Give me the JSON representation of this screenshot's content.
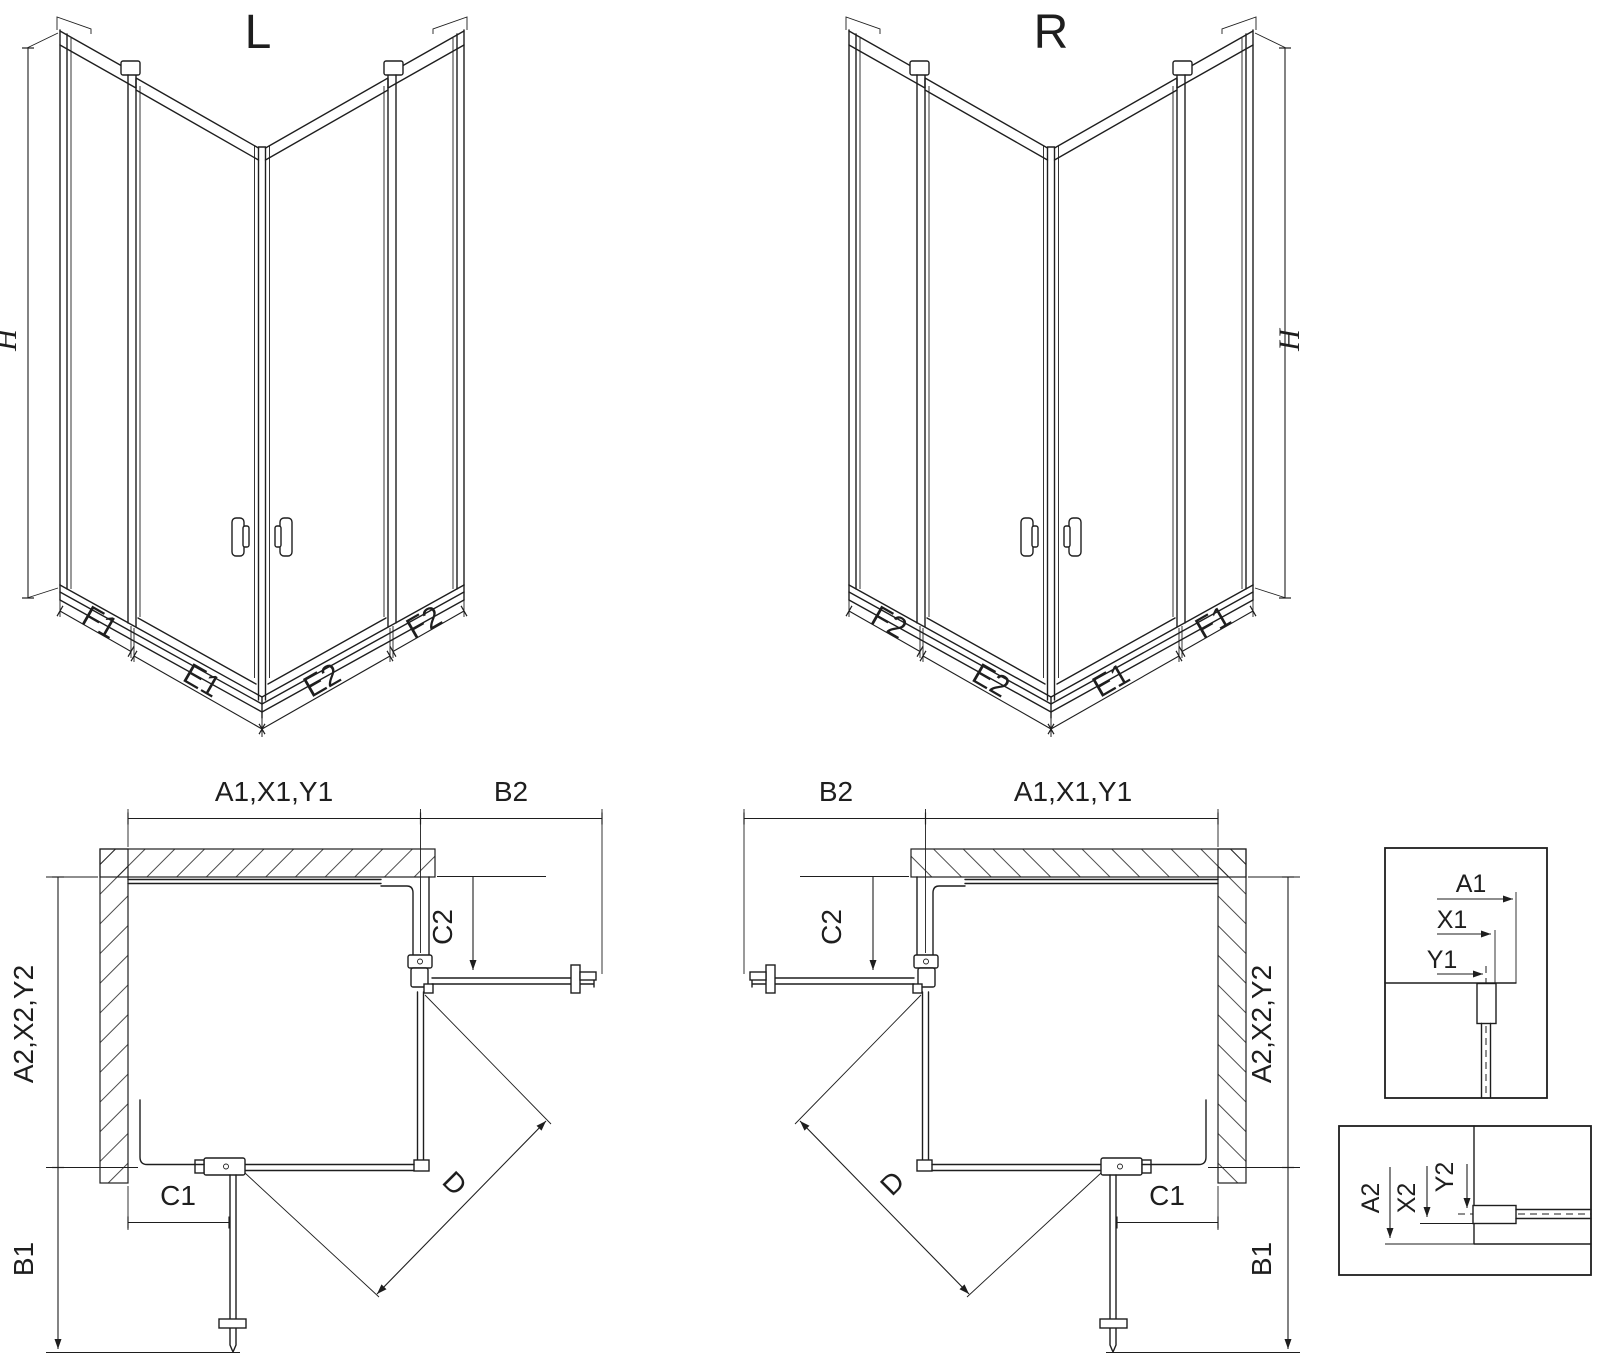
{
  "colors": {
    "line": "#1e1e1e",
    "background": "#ffffff"
  },
  "views": {
    "iso_left": {
      "title": "L",
      "labels": {
        "height": "H",
        "f_left": "F1",
        "e_left": "E1",
        "e_right": "E2",
        "f_right": "F2"
      }
    },
    "iso_right": {
      "title": "R",
      "labels": {
        "height": "H",
        "f_left": "F2",
        "e_left": "E2",
        "e_right": "E1",
        "f_right": "F1"
      }
    },
    "plan_left": {
      "labels": {
        "width_top": "A1,X1,Y1",
        "door_side": "B2",
        "c2": "C2",
        "depth_side": "A2,X2,Y2",
        "c1": "C1",
        "door_front": "B1",
        "diagonal": "D"
      }
    },
    "plan_right": {
      "labels": {
        "width_top": "A1,X1,Y1",
        "door_side": "B2",
        "c2": "C2",
        "depth_side": "A2,X2,Y2",
        "c1": "C1",
        "door_front": "B1",
        "diagonal": "D"
      }
    },
    "detail_width": {
      "labels": {
        "a": "A1",
        "x": "X1",
        "y": "Y1"
      }
    },
    "detail_depth": {
      "labels": {
        "a": "A2",
        "x": "X2",
        "y": "Y2"
      }
    }
  }
}
